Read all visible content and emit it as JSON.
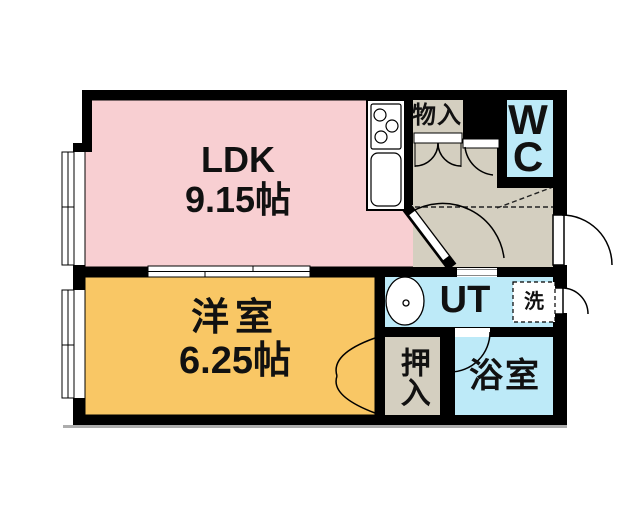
{
  "colors": {
    "ldk": "#F8CFD2",
    "western_room": "#F9C765",
    "water_rooms": "#BDEAF8",
    "hall": "#D4CFC0",
    "wall": "#000000"
  },
  "rooms": {
    "ldk": {
      "name": "LDK",
      "size": "9.15帖"
    },
    "western": {
      "name": "洋室",
      "size": "6.25帖"
    },
    "wc": {
      "line1": "W",
      "line2": "C"
    },
    "ut": {
      "name": "UT"
    },
    "storage": {
      "name": "物入"
    },
    "closet": {
      "name": "押入"
    },
    "bath": {
      "name": "浴室"
    }
  },
  "fixtures": {
    "washing_machine": "洗"
  }
}
